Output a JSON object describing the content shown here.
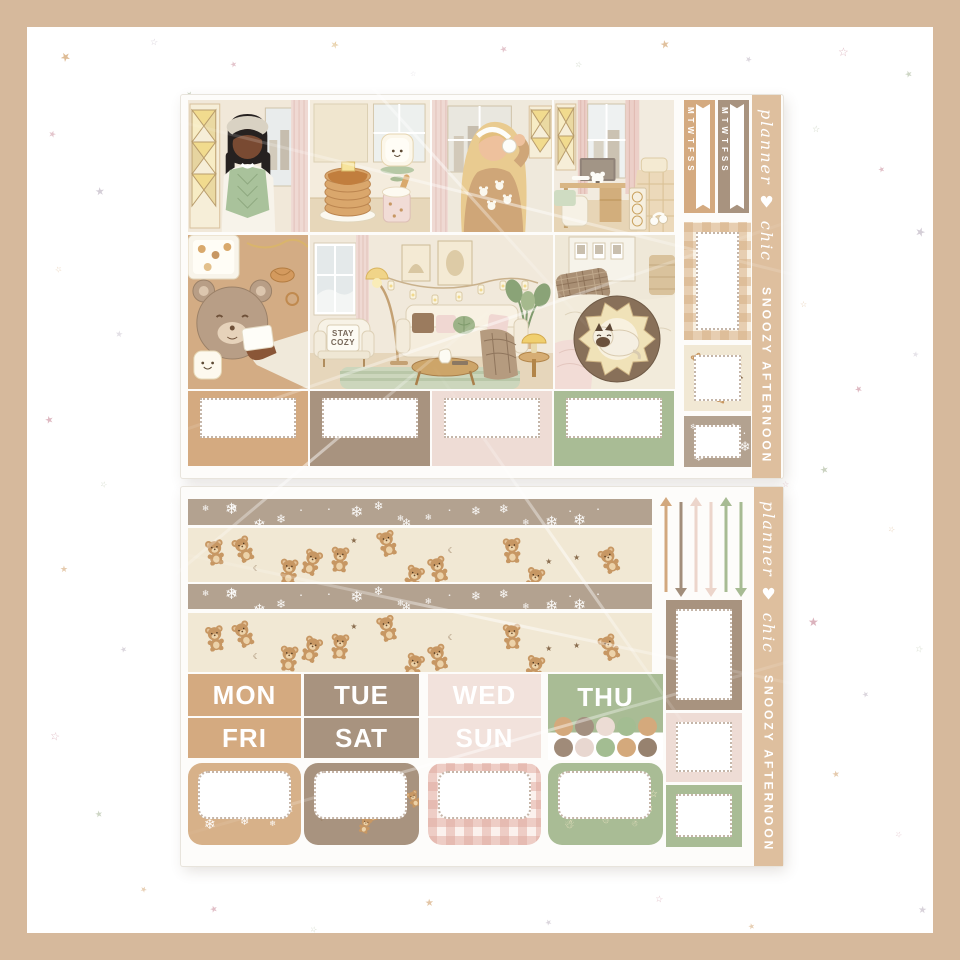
{
  "page": {
    "background": "#ffffff",
    "frame_color": "#d6b99c"
  },
  "brand": {
    "script": "planner ♥ chic",
    "kit_name": "SNOOZY AFTERNOON"
  },
  "palette": {
    "tan": "#d4aa80",
    "taupe": "#a8937f",
    "blush": "#f2e2dc",
    "sage": "#a9bc95",
    "washi_taupe": "#b3a290",
    "washi_cream": "#f1e8d4",
    "strip_tan": "#debf9e",
    "bear_brown": "#c79763"
  },
  "sheet1": {
    "flags": [
      {
        "label": "MTWTFSS",
        "color": "#d4aa80"
      },
      {
        "label": "MTWTFSS",
        "color": "#a8937f"
      }
    ],
    "scenes": [
      "girl-in-green-vest",
      "pancakes-and-toast",
      "girl-in-bear-sweater",
      "bedroom-desk",
      "bear-cookie-flatlay",
      "cozy-living-room",
      "cat-in-bear-bed"
    ],
    "pillow": {
      "line1": "STAY",
      "line2": "COZY"
    },
    "label_boxes": [
      "#d4aa80",
      "#a8937f",
      "#eedcd5",
      "#a9bc95"
    ],
    "right_boxes": [
      {
        "pattern": "gingham",
        "tone": "tan"
      },
      {
        "pattern": "bears",
        "tone": "cream"
      },
      {
        "pattern": "snow",
        "tone": "taupe"
      }
    ]
  },
  "sheet2": {
    "washi_strips": [
      {
        "pattern": "snow",
        "tone": "taupe"
      },
      {
        "pattern": "bears",
        "tone": "cream"
      },
      {
        "pattern": "snow",
        "tone": "taupe"
      },
      {
        "pattern": "bears",
        "tone": "cream"
      }
    ],
    "day_headers": {
      "row1": [
        {
          "label": "MON",
          "color": "#d4aa80"
        },
        {
          "label": "TUE",
          "color": "#a8937f"
        },
        {
          "label": "WED",
          "color": "#f2e2dc"
        },
        {
          "label": "THU",
          "color": "#a9bc95"
        }
      ],
      "row2": [
        {
          "label": "FRI",
          "color": "#d4aa80"
        },
        {
          "label": "SAT",
          "color": "#a8937f"
        },
        {
          "label": "SUN",
          "color": "#f2e2dc"
        }
      ]
    },
    "dot_colors": [
      "#d4a97c",
      "#a39080",
      "#ecdcd4",
      "#a3bd92",
      "#d4a97c",
      "#a08b79",
      "#e8d7d0",
      "#a3bd92",
      "#d4a97c",
      "#97826f"
    ],
    "arrows": [
      {
        "color": "#d2a87e",
        "direction": "up"
      },
      {
        "color": "#a28e7b",
        "direction": "down"
      },
      {
        "color": "#ecd5cb",
        "direction": "up"
      },
      {
        "color": "#ecd5cb",
        "direction": "down"
      },
      {
        "color": "#a7bb93",
        "direction": "up"
      },
      {
        "color": "#a7bb93",
        "direction": "down"
      }
    ],
    "label_boxes": [
      {
        "pattern": "snow",
        "tone": "tan"
      },
      {
        "pattern": "bears",
        "tone": "taupe"
      },
      {
        "pattern": "gingham",
        "tone": "pink"
      },
      {
        "pattern": "doodles",
        "tone": "sage"
      }
    ],
    "right_boxes": [
      "#a8937f",
      "#eedcd5",
      "#a9bc95"
    ]
  },
  "decor": {
    "star_colors": [
      "#c98c9b",
      "#d1a06b",
      "#9fae8d",
      "#b9aebd",
      "#c9c2cf"
    ],
    "stars": [
      [
        60,
        50,
        12,
        "#d1a06b",
        "★",
        0.7
      ],
      [
        150,
        38,
        9,
        "#b9aebd",
        "☆",
        0.55
      ],
      [
        230,
        60,
        8,
        "#c98c9b",
        "★",
        0.5
      ],
      [
        330,
        40,
        10,
        "#d8b06e",
        "★",
        0.6
      ],
      [
        410,
        70,
        7,
        "#c9c2cf",
        "☆",
        0.45
      ],
      [
        500,
        45,
        9,
        "#c98c9b",
        "★",
        0.5
      ],
      [
        575,
        60,
        8,
        "#9fae8d",
        "☆",
        0.5
      ],
      [
        660,
        38,
        11,
        "#d1a06b",
        "★",
        0.65
      ],
      [
        745,
        55,
        8,
        "#b9aebd",
        "★",
        0.5
      ],
      [
        838,
        45,
        12,
        "#c98c9b",
        "☆",
        0.6
      ],
      [
        905,
        70,
        9,
        "#9fae8d",
        "★",
        0.5
      ],
      [
        48,
        130,
        9,
        "#c98c9b",
        "★",
        0.5
      ],
      [
        95,
        185,
        11,
        "#b9aebd",
        "★",
        0.6
      ],
      [
        55,
        265,
        8,
        "#d1a06b",
        "☆",
        0.5
      ],
      [
        115,
        330,
        9,
        "#c9c2cf",
        "★",
        0.5
      ],
      [
        45,
        415,
        10,
        "#c98c9b",
        "★",
        0.6
      ],
      [
        100,
        480,
        8,
        "#9fae8d",
        "☆",
        0.5
      ],
      [
        60,
        565,
        9,
        "#d1a06b",
        "★",
        0.55
      ],
      [
        120,
        645,
        8,
        "#b9aebd",
        "★",
        0.5
      ],
      [
        50,
        730,
        11,
        "#c98c9b",
        "☆",
        0.6
      ],
      [
        95,
        810,
        9,
        "#9fae8d",
        "★",
        0.5
      ],
      [
        140,
        885,
        8,
        "#d1a06b",
        "★",
        0.5
      ],
      [
        812,
        125,
        9,
        "#9fae8d",
        "☆",
        0.5
      ],
      [
        878,
        165,
        8,
        "#c98c9b",
        "★",
        0.55
      ],
      [
        915,
        225,
        12,
        "#b9aebd",
        "★",
        0.6
      ],
      [
        800,
        300,
        8,
        "#d1a06b",
        "☆",
        0.5
      ],
      [
        855,
        385,
        9,
        "#c98c9b",
        "★",
        0.6
      ],
      [
        912,
        350,
        8,
        "#c9c2cf",
        "★",
        0.45
      ],
      [
        820,
        465,
        10,
        "#9fae8d",
        "★",
        0.55
      ],
      [
        888,
        525,
        8,
        "#d1a06b",
        "☆",
        0.5
      ],
      [
        808,
        615,
        12,
        "#c98c9b",
        "★",
        0.65
      ],
      [
        862,
        690,
        8,
        "#b9aebd",
        "★",
        0.5
      ],
      [
        915,
        645,
        9,
        "#9fae8d",
        "☆",
        0.5
      ],
      [
        832,
        770,
        9,
        "#d1a06b",
        "★",
        0.55
      ],
      [
        895,
        830,
        8,
        "#c98c9b",
        "☆",
        0.5
      ],
      [
        918,
        905,
        10,
        "#b9aebd",
        "★",
        0.55
      ],
      [
        210,
        905,
        9,
        "#c98c9b",
        "★",
        0.55
      ],
      [
        310,
        925,
        8,
        "#9fae8d",
        "☆",
        0.5
      ],
      [
        425,
        898,
        10,
        "#d1a06b",
        "★",
        0.6
      ],
      [
        545,
        918,
        8,
        "#b9aebd",
        "★",
        0.5
      ],
      [
        655,
        895,
        9,
        "#c98c9b",
        "☆",
        0.55
      ],
      [
        748,
        922,
        8,
        "#d1a06b",
        "★",
        0.5
      ],
      [
        186,
        90,
        8,
        "#9fae8d",
        "★",
        0.5
      ],
      [
        782,
        480,
        8,
        "#c98c9b",
        "☆",
        0.45
      ]
    ]
  }
}
